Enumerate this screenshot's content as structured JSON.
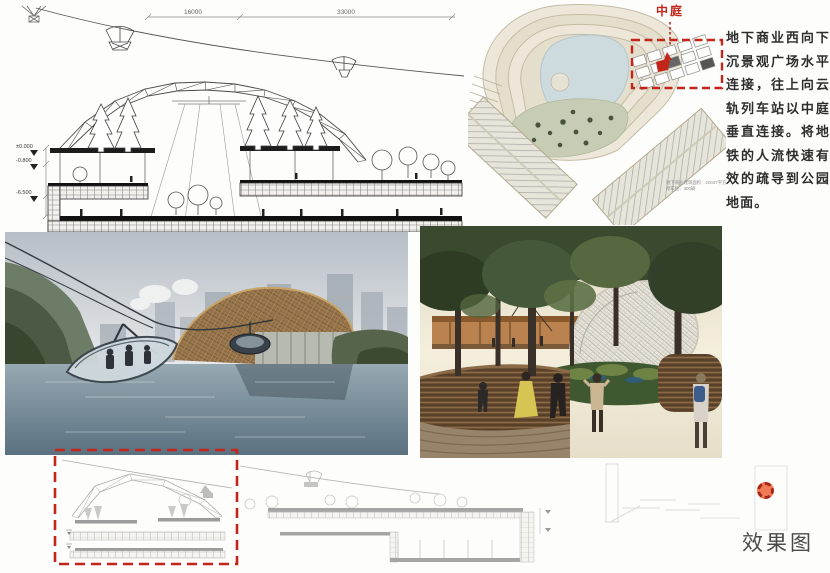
{
  "section_top": {
    "dim_left": "16000",
    "dim_right": "33000",
    "levels": [
      "±0.000",
      "-0.800",
      "-6.500"
    ]
  },
  "site_plan": {
    "atrium_label": "中庭",
    "caption": [
      "地下商业建筑面积：20047平方米",
      "停车位：300辆"
    ]
  },
  "description": {
    "text": "地下商业西向下沉景观广场水平连接，往上向云轨列车站以中庭垂直连接。将地铁的人流快速有效的疏导到公园地面。"
  },
  "footer": {
    "rendering_label": "效果图"
  },
  "icons": {
    "marker": "red-dashed-circle-marker"
  },
  "colors": {
    "annotation_red": "#c2251a",
    "lake_blue": "#cddade",
    "lawn_green": "#c7cdb4",
    "terrace_cream": "#e9e4d6",
    "drawing_ink": "#3c3c3c",
    "faint_ink": "#b5b5b5",
    "text_dark": "#2e2e2e"
  }
}
